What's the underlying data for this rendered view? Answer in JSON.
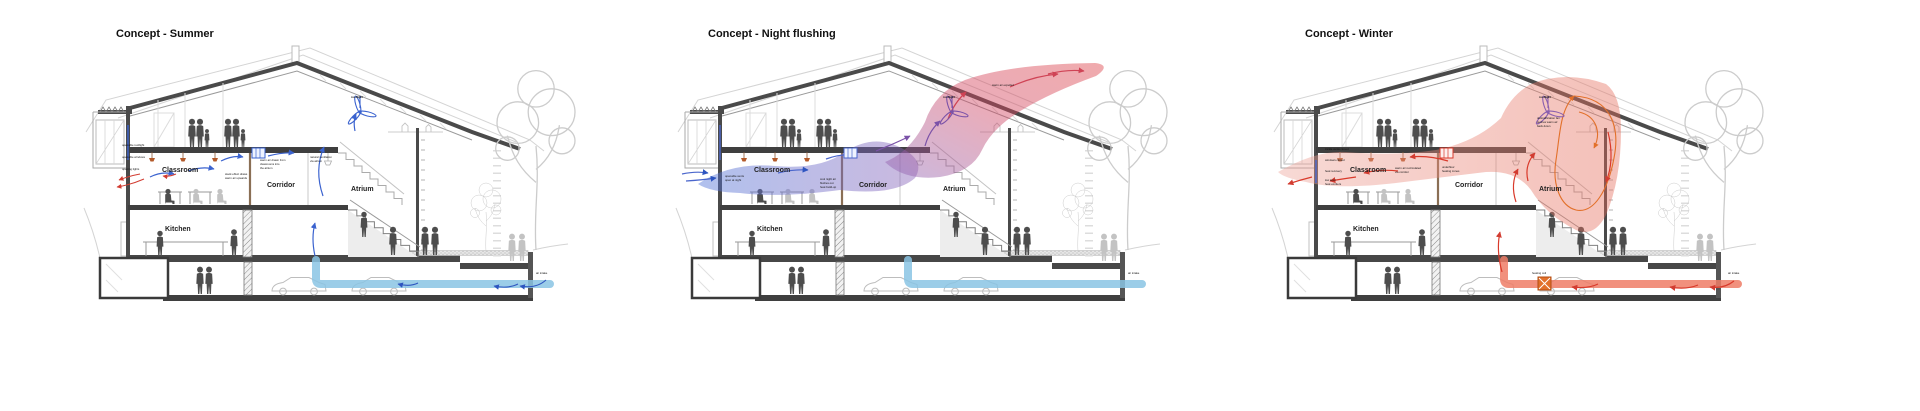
{
  "page": {
    "background": "#ffffff",
    "description_keys": "building section ventilation concept diagrams"
  },
  "palette": {
    "line_dark": "#4a4a4a",
    "line_mid": "#9a9a9a",
    "line_light": "#cfcfcf",
    "people_dark": "#4d4d4d",
    "people_light": "#c0c0c0"
  },
  "panels": [
    {
      "title": "Concept - Summer",
      "rooms": {
        "classroom": "Classroom",
        "corridor": "Corridor",
        "atrium": "Atrium",
        "kitchen": "Kitchen"
      },
      "labels": {
        "rooflight": "rooflight",
        "air_intake": "air intake"
      },
      "annotations": [
        "openable rooflight",
        "openable windows",
        "opening lights",
        "stack effect draws",
        "warm air upwards",
        "warm air drawn from",
        "classrooms into",
        "the atrium",
        "natural ventilation",
        "via atrium"
      ],
      "colors": {
        "flow": "#3b63cf",
        "flow_dark": "#2e55c0",
        "exhaust": "#d23c31",
        "duct": "#8ac4e4"
      }
    },
    {
      "title": "Concept - Night flushing",
      "rooms": {
        "classroom": "Classroom",
        "corridor": "Corridor",
        "atrium": "Atrium",
        "kitchen": "Kitchen"
      },
      "labels": {
        "rooflight": "rooflight",
        "air_intake": "air intake",
        "air_out": "warm air expelled"
      },
      "annotations": [
        "openable vents",
        "open at night",
        "cool night air",
        "flushes out",
        "heat build-up"
      ],
      "colors": {
        "cool_in": "#4a66cc",
        "warm_out": "#cf4355",
        "duct": "#8ac4e4",
        "cloud_cool": "#4f74d8",
        "cloud_mid": "#8a63b8",
        "cloud_warm": "#dd4348"
      }
    },
    {
      "title": "Concept - Winter",
      "rooms": {
        "classroom": "Classroom",
        "corridor": "Corridor",
        "atrium": "Atrium",
        "kitchen": "Kitchen"
      },
      "labels": {
        "rooflight": "rooflight",
        "air_intake": "air intake",
        "heater": "heating coil"
      },
      "annotations": [
        "trickle vents closed",
        "windows closed",
        "heat recovery",
        "low level",
        "heat emitters",
        "destratification fan",
        "pushes warm air",
        "back down",
        "warm air recirculated",
        "via corridor",
        "underfloor",
        "heating zones"
      ],
      "colors": {
        "flow": "#d93a2b",
        "loop": "#e2702a",
        "cloud": "#e8766a",
        "duct": "#ef7d66"
      }
    }
  ]
}
